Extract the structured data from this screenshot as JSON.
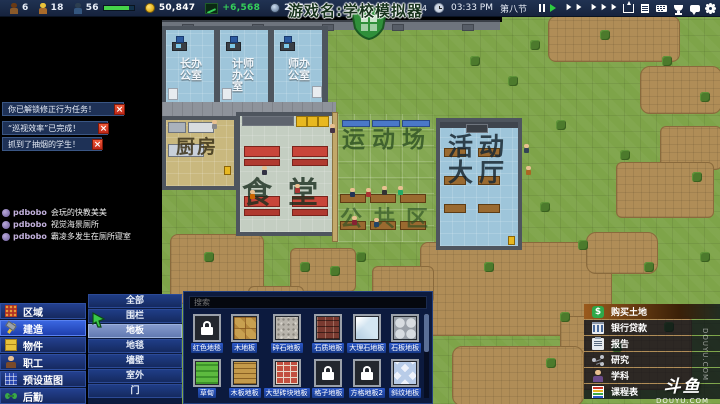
{
  "colors": {
    "topbar_bg": "#1b2a47",
    "accent_blue": "#2b57c8",
    "selected_blue": "#3a66e0",
    "money_green": "#35d05a",
    "alert_red": "#e03a2a",
    "buy_land_orange": "#9a5a1c",
    "grass_green": "#7ea449",
    "dirt_brown": "#b08d57"
  },
  "hud": {
    "stats": [
      {
        "icon": "student-icon",
        "value": "6"
      },
      {
        "icon": "worker-icon",
        "value": "18"
      },
      {
        "icon": "guard-icon",
        "value": "56",
        "has_progress_bar": true
      },
      {
        "icon": "coin-icon",
        "value": "50,847"
      },
      {
        "icon": "trend-chart-icon",
        "value": "+6,568"
      },
      {
        "icon": "badge-icon",
        "value": "237"
      }
    ],
    "right": {
      "count_label": "数 4",
      "time": "03:33 PM",
      "period": "第八节",
      "playback_icons": [
        "pause-icon",
        "play-icon",
        "fast-forward-icon",
        "fastest-forward-icon"
      ],
      "menu_icons": [
        "share-icon",
        "report-doc-icon",
        "keyboard-icon",
        "trophy-icon",
        "chat-bubble-icon",
        "gear-icon"
      ]
    }
  },
  "overlay": {
    "stream_title": "游戏名:学校模拟器",
    "logo": "shield-logo-icon",
    "chat": [
      {
        "user": "pdbobo",
        "message": "会玩的快教美美"
      },
      {
        "user": "pdbobo",
        "message": "视觉海景厕所"
      },
      {
        "user": "pdbobo",
        "message": "霸凌多发生在厕所寝室"
      }
    ],
    "watermark_vertical": "DOUYU.COM",
    "watermark_logo": "斗鱼",
    "watermark_site": "DOUYU.COM"
  },
  "notifications": {
    "close_glyph": "×",
    "items": [
      "你已解锁修正行为任务！",
      "“巡视效率”已完成！",
      "抓到了抽烟的学生！"
    ]
  },
  "map": {
    "rooms": {
      "office_1": "长办公室",
      "office_2": "计师办公室",
      "office_3": "师办公室",
      "kitchen": "厨房",
      "canteen": "食堂",
      "sports_field": "运动场",
      "public_area": "公共区",
      "activity_hall": "活动大厅"
    }
  },
  "build_menu": {
    "items": [
      {
        "label": "区域",
        "icon": "zone-grid-icon",
        "selected": false
      },
      {
        "label": "建造",
        "icon": "hammer-icon",
        "selected": true
      },
      {
        "label": "物件",
        "icon": "object-box-icon",
        "selected": false
      },
      {
        "label": "职工",
        "icon": "staff-person-icon",
        "selected": false
      },
      {
        "label": "预设蓝图",
        "icon": "blueprint-grid-icon",
        "selected": false
      },
      {
        "label": "后勤",
        "icon": "logistics-icon",
        "selected": false
      }
    ],
    "categories": [
      {
        "label": "全部",
        "selected": false
      },
      {
        "label": "围栏",
        "selected": false
      },
      {
        "label": "地板",
        "selected": true
      },
      {
        "label": "地毯",
        "selected": false
      },
      {
        "label": "墙壁",
        "selected": false
      },
      {
        "label": "室外",
        "selected": false
      },
      {
        "label": "门",
        "selected": false
      }
    ]
  },
  "palette": {
    "search_placeholder": "搜索",
    "rows": [
      [
        {
          "label": "红色地毯",
          "icon": "lock-icon",
          "locked": true
        },
        {
          "label": "木地板",
          "icon": "wood-parquet-tile"
        },
        {
          "label": "碎石地板",
          "icon": "gravel-tile"
        },
        {
          "label": "石质地板",
          "icon": "dark-stone-brick-tile"
        },
        {
          "label": "大理石地板",
          "icon": "marble-tile"
        },
        {
          "label": "石板地板",
          "icon": "flagstone-tile"
        }
      ],
      [
        {
          "label": "草甸",
          "icon": "grass-tile"
        },
        {
          "label": "木板地板",
          "icon": "wood-plank-tile"
        },
        {
          "label": "大型砖块地板",
          "icon": "red-brick-tile"
        },
        {
          "label": "格子地板",
          "icon": "lock-icon",
          "locked": true
        },
        {
          "label": "方格地板2",
          "icon": "lock-icon",
          "locked": true
        },
        {
          "label": "斜纹地板",
          "icon": "diamond-tile"
        }
      ]
    ]
  },
  "right_menu": {
    "items": [
      {
        "label": "购买土地",
        "icon": "dollar-icon",
        "dollar_glyph": "$",
        "selected": true
      },
      {
        "label": "银行贷款",
        "icon": "bank-icon",
        "selected": false
      },
      {
        "label": "报告",
        "icon": "report-icon",
        "selected": false
      },
      {
        "label": "研究",
        "icon": "research-icon",
        "selected": false
      },
      {
        "label": "学科",
        "icon": "subject-person-icon",
        "selected": false
      },
      {
        "label": "课程表",
        "icon": "schedule-icon",
        "selected": false
      }
    ]
  }
}
